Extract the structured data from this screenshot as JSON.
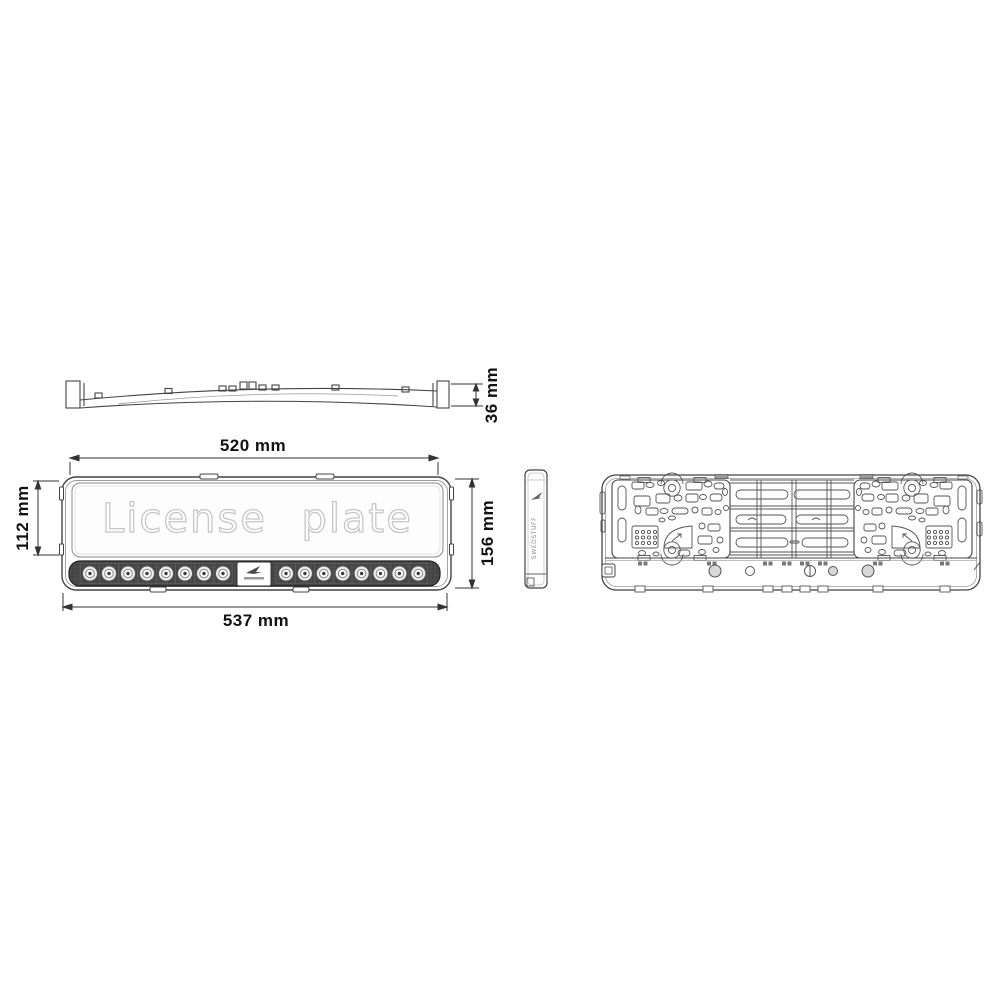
{
  "drawing": {
    "type": "technical-diagram",
    "subject": "LED license plate holder",
    "front_view": {
      "plate_text": "License plate",
      "led_count_left": 8,
      "led_count_right": 8
    },
    "side_view": {
      "brand_text": "SWEDSTUFF"
    },
    "dimensions": {
      "profile_height": "36 mm",
      "inner_width": "520 mm",
      "window_height": "112 mm",
      "total_height": "156 mm",
      "total_width": "537 mm"
    },
    "colors": {
      "line": "#444444",
      "dimension_text": "#111111",
      "plate_text_outline": "#c6c6c6",
      "led_strip": "#4a4a4a"
    }
  }
}
